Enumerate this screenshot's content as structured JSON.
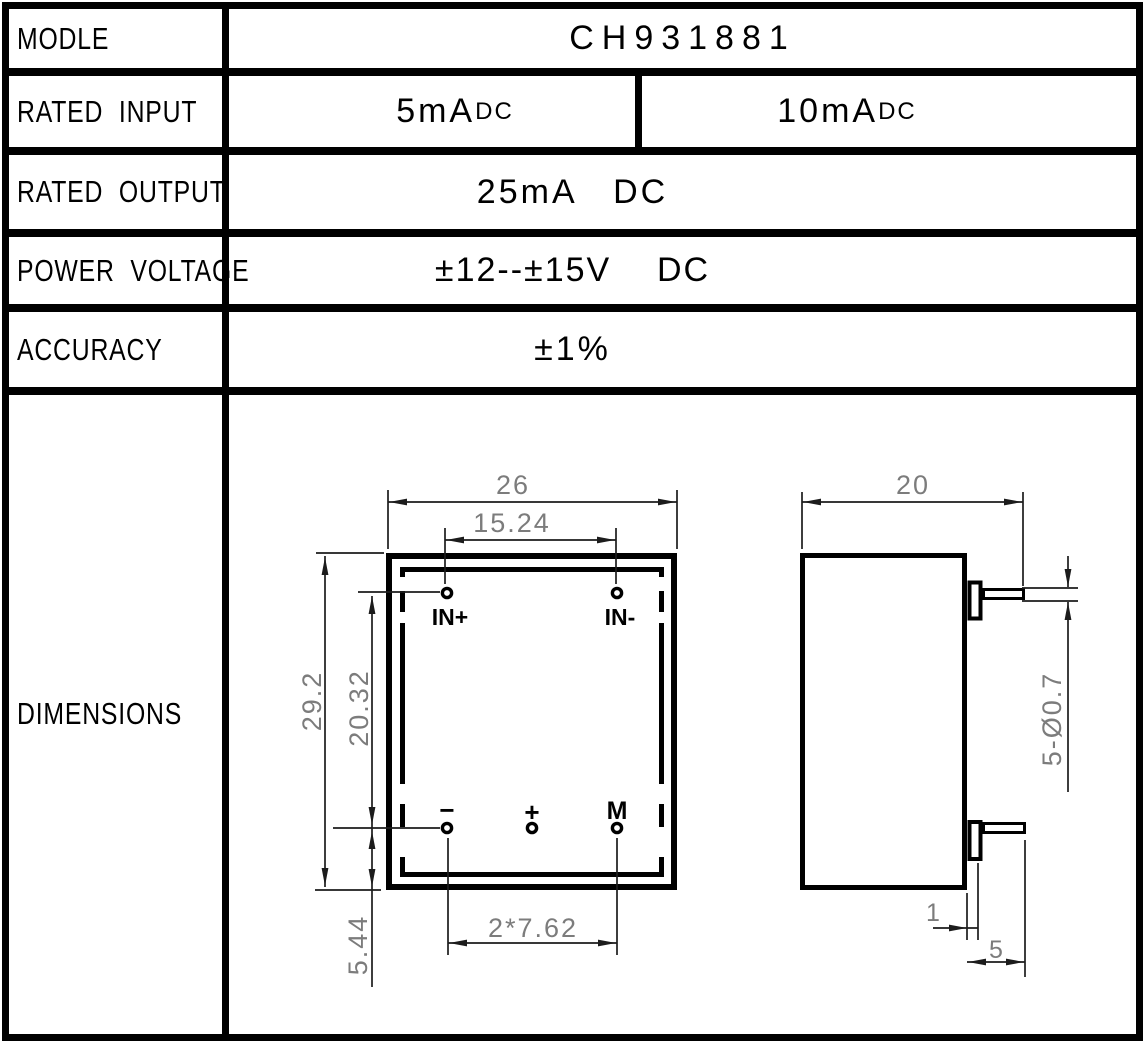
{
  "table": {
    "rows": [
      {
        "label": "MODLE",
        "value": "CH931881"
      },
      {
        "label": "RATED INPUT",
        "left": {
          "amount": "5mA",
          "unit": "DC"
        },
        "right": {
          "amount": "10mA",
          "unit": "DC"
        }
      },
      {
        "label": "RATED OUTPUT",
        "value": "25mA   DC"
      },
      {
        "label": "POWER VOLTAGE",
        "value": "±12--±15V    DC"
      },
      {
        "label": "ACCURACY",
        "value": "±1%"
      },
      {
        "label": "DIMENSIONS"
      }
    ]
  },
  "drawing": {
    "front_view": {
      "dim_width": "26",
      "dim_top_pin_spacing": "15.24",
      "dim_height": "29.2",
      "dim_pin_row_spacing": "20.32",
      "dim_bottom_pin_offset": "5.44",
      "dim_bottom_pin_spacing": "2*7.62",
      "pin_top_left": "IN+",
      "pin_top_right": "IN-",
      "pin_bottom_left": "−",
      "pin_bottom_mid": "+",
      "pin_bottom_right": "M"
    },
    "side_view": {
      "dim_depth": "20",
      "dim_lead_spec": "5-Ø0.7",
      "dim_lead_inset": "1",
      "dim_lead_length": "5"
    }
  },
  "colors": {
    "line": "#000000",
    "dimension_text": "#7c7c7c",
    "background": "#ffffff"
  }
}
